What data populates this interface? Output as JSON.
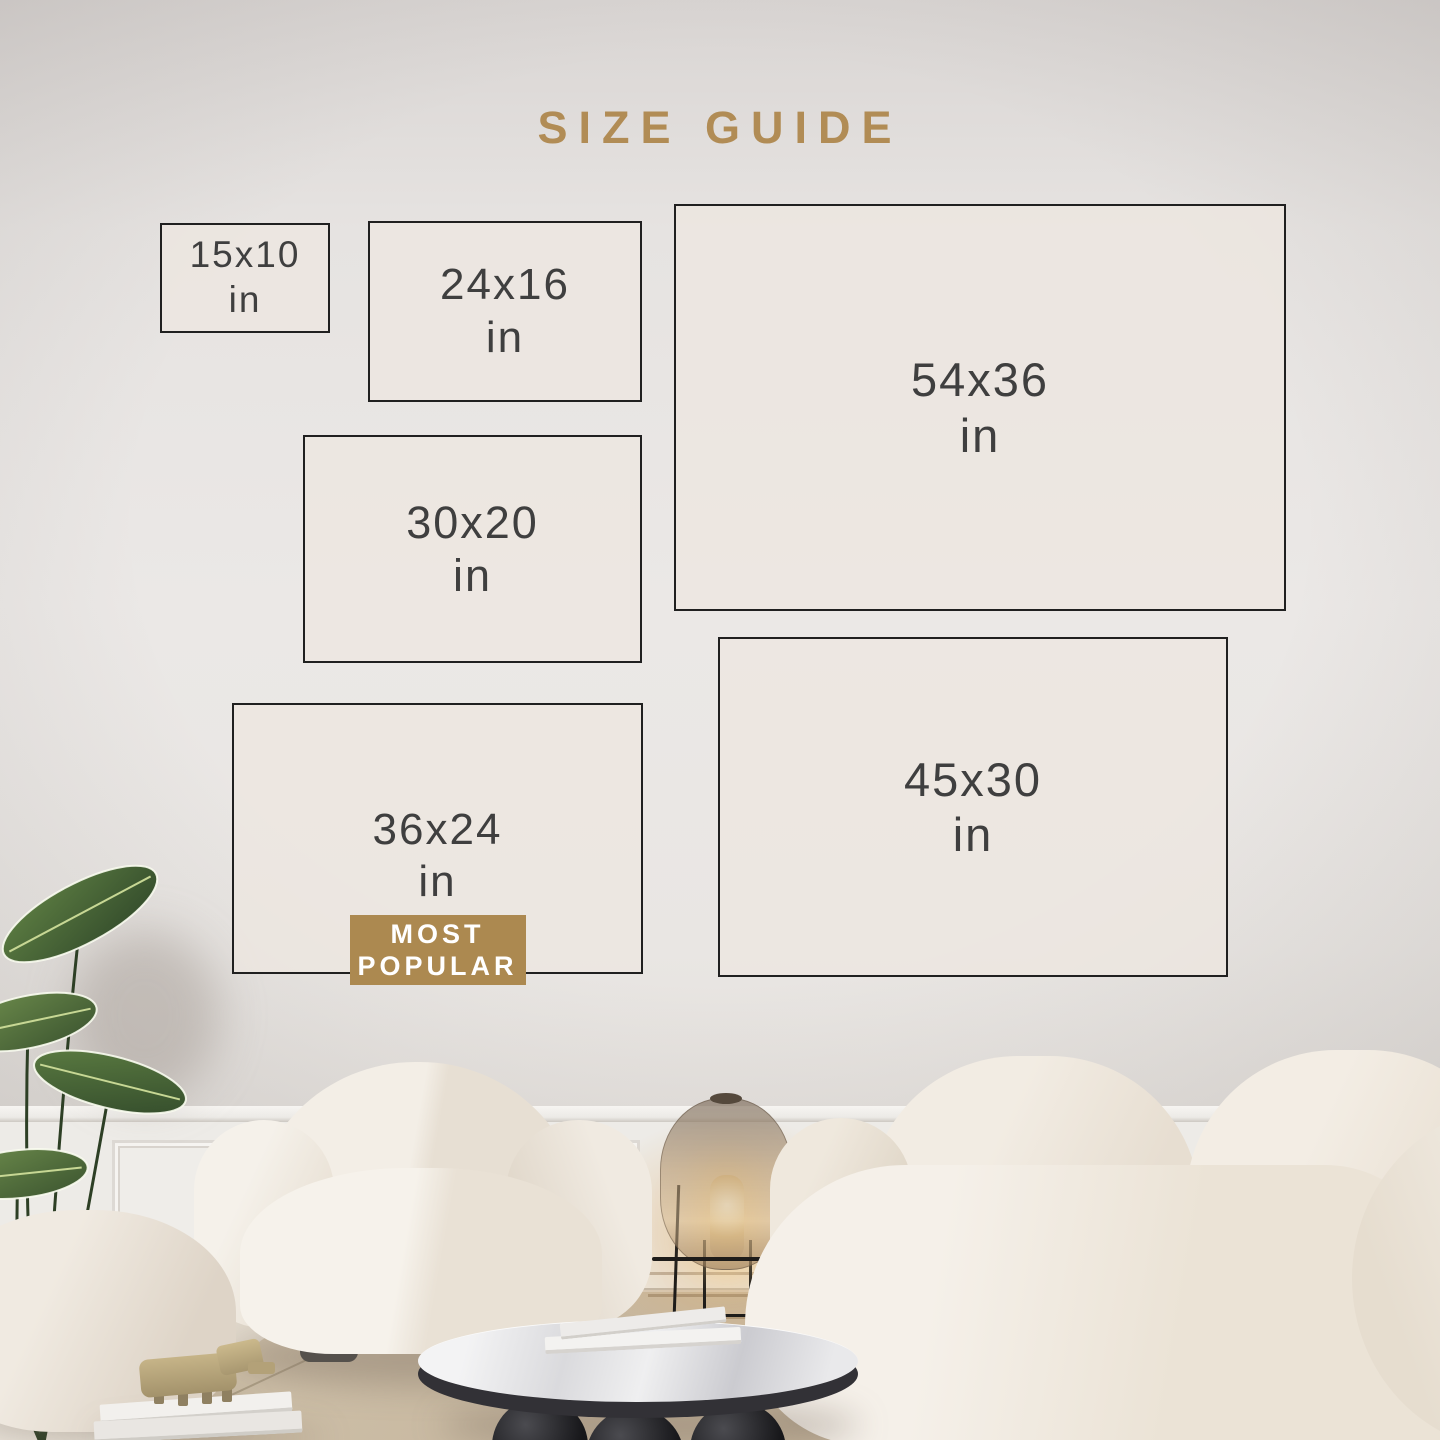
{
  "page": {
    "title": "SIZE GUIDE"
  },
  "sizes": [
    {
      "label": "15x10",
      "unit": "in"
    },
    {
      "label": "24x16",
      "unit": "in"
    },
    {
      "label": "54x36",
      "unit": "in"
    },
    {
      "label": "30x20",
      "unit": "in"
    },
    {
      "label": "36x24",
      "unit": "in",
      "badge": {
        "line1": "MOST",
        "line2": "POPULAR"
      }
    },
    {
      "label": "45x30",
      "unit": "in"
    }
  ],
  "colors": {
    "accent_gold": "#b18c55",
    "badge_background": "#ac8950",
    "badge_text": "#ffffff",
    "frame_border": "#202020",
    "frame_fill": "#e5e0da",
    "label_text": "#3f3f3f",
    "wall": "#e9e6e3",
    "rug": "#c6b69e",
    "upholstery": "#f1ebe2",
    "plant_green": "#46633a",
    "lamp_amber": "#b2956f"
  },
  "scene_objects": [
    "potted-plant",
    "pouf",
    "armchair",
    "floor-lamp",
    "sofa",
    "coffee-table",
    "books",
    "animal-figurine",
    "rug",
    "wainscoting"
  ]
}
